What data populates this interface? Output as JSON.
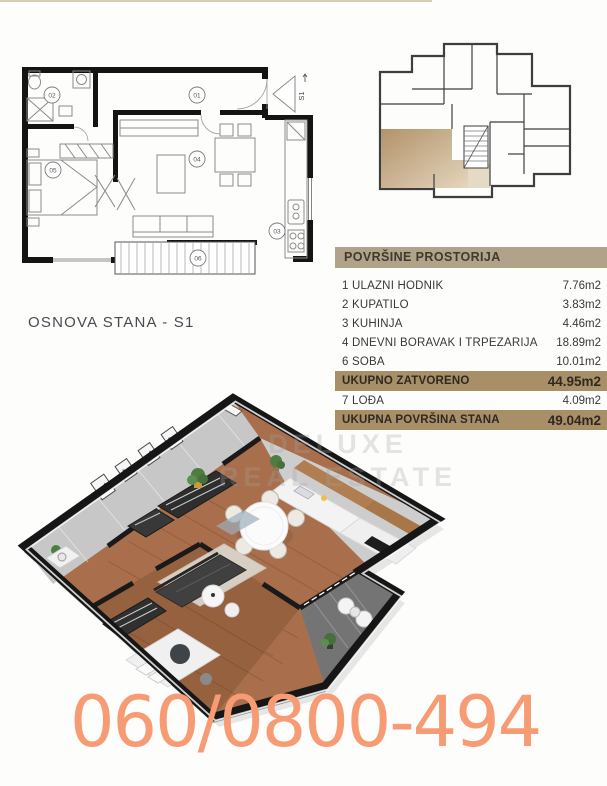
{
  "plan2d": {
    "caption": "OSNOVA STANA - S1",
    "entrance_marker": "S1",
    "rooms": {
      "r1": "01",
      "r2": "02",
      "r3": "03",
      "r4": "04",
      "r5": "05",
      "r6": "06"
    }
  },
  "area_table": {
    "title": "POVRŠINE PROSTORIJA",
    "rows": [
      {
        "label": "1 ULAZNI HODNIK",
        "value": "7.76m2"
      },
      {
        "label": "2 KUPATILO",
        "value": "3.83m2"
      },
      {
        "label": "3 KUHINJA",
        "value": "4.46m2"
      },
      {
        "label": "4 DNEVNI BORAVAK I TRPEZARIJA",
        "value": "18.89m2"
      },
      {
        "label": "6 SOBA",
        "value": "10.01m2"
      },
      {
        "label": "UKUPNO ZATVORENO",
        "value": "44.95m2"
      },
      {
        "label": "7 LOĐA",
        "value": "4.09m2"
      },
      {
        "label": "UKUPNA POVRŠINA STANA",
        "value": "49.04m2"
      }
    ]
  },
  "watermark": {
    "line1": "DELUXE",
    "line2": "REAL ESTATE"
  },
  "phone": "060/0800-494",
  "colors": {
    "table_header_bg": "#b1a28a",
    "table_total_bg": "#a98f68",
    "phone_color": "#f79b74",
    "highlighted_unit": "#bfa076",
    "top_line": "#d9ccb4"
  }
}
